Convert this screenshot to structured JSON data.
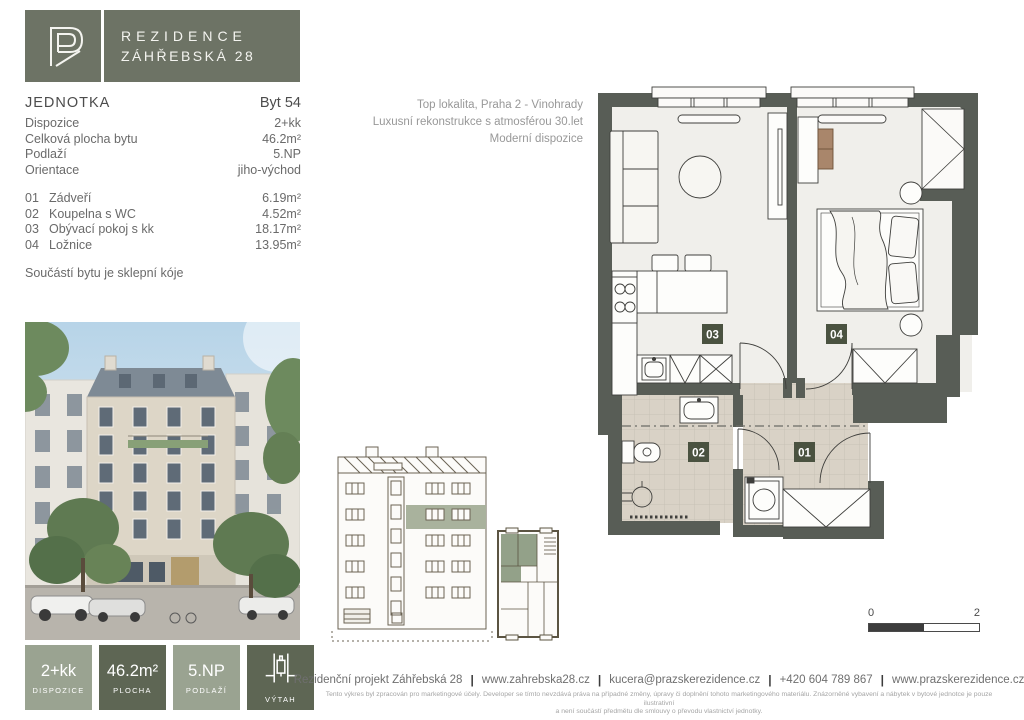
{
  "logo": {
    "monogram": "PR",
    "line1": "REZIDENCE",
    "line2": "ZÁHŘEBSKÁ 28"
  },
  "highlights": {
    "line1": "Top lokalita, Praha 2 - Vinohrady",
    "line2": "Luxusní rekonstrukce s atmosférou 30.let",
    "line3": "Moderní dispozice"
  },
  "unit": {
    "title_label": "JEDNOTKA",
    "title_value": "Byt 54",
    "rows": [
      {
        "label": "Dispozice",
        "value": "2+kk"
      },
      {
        "label": "Celková plocha bytu",
        "value": "46.2m²"
      },
      {
        "label": "Podlaží",
        "value": "5.NP"
      },
      {
        "label": "Orientace",
        "value": "jiho-východ"
      }
    ],
    "rooms": [
      {
        "num": "01",
        "name": "Zádveří",
        "area": "6.19m²"
      },
      {
        "num": "02",
        "name": "Koupelna s WC",
        "area": "4.52m²"
      },
      {
        "num": "03",
        "name": "Obývací pokoj s kk",
        "area": "18.17m²"
      },
      {
        "num": "04",
        "name": "Ložnice",
        "area": "13.95m²"
      }
    ],
    "note": "Součástí bytu je sklepní kóje"
  },
  "plan": {
    "tags": {
      "t01": "01",
      "t02": "02",
      "t03": "03",
      "t04": "04"
    },
    "scale": {
      "start": "0",
      "end": "2"
    }
  },
  "badges": [
    {
      "value": "2+kk",
      "label": "DISPOZICE"
    },
    {
      "value": "46.2m²",
      "label": "PLOCHA"
    },
    {
      "value": "5.NP",
      "label": "PODLAŽÍ"
    },
    {
      "value": "",
      "label": "VÝTAH"
    }
  ],
  "footer": {
    "separator": "|",
    "items": [
      "Rezidenční projekt Záhřebská 28",
      "www.zahrebska28.cz",
      "kucera@prazskerezidence.cz",
      "+420 604 789 867",
      "www.prazskerezidence.cz"
    ],
    "disclaimer1": "Tento výkres byl zpracován pro marketingové účely. Developer se tímto nevzdává práva na případné změny, úpravy či doplnění tohoto marketingového materiálu. Znázorněné vybavení a nábytek v bytové jednotce je pouze ilustrativní",
    "disclaimer2": "a není součástí předmětu dle smlouvy o převodu vlastnictví jednotky."
  },
  "colors": {
    "brand_green": "#6d7365",
    "badge_light": "#9aa391",
    "badge_dark": "#5e6654",
    "tag_green": "#4a5240",
    "wall_gray": "#585d56"
  }
}
